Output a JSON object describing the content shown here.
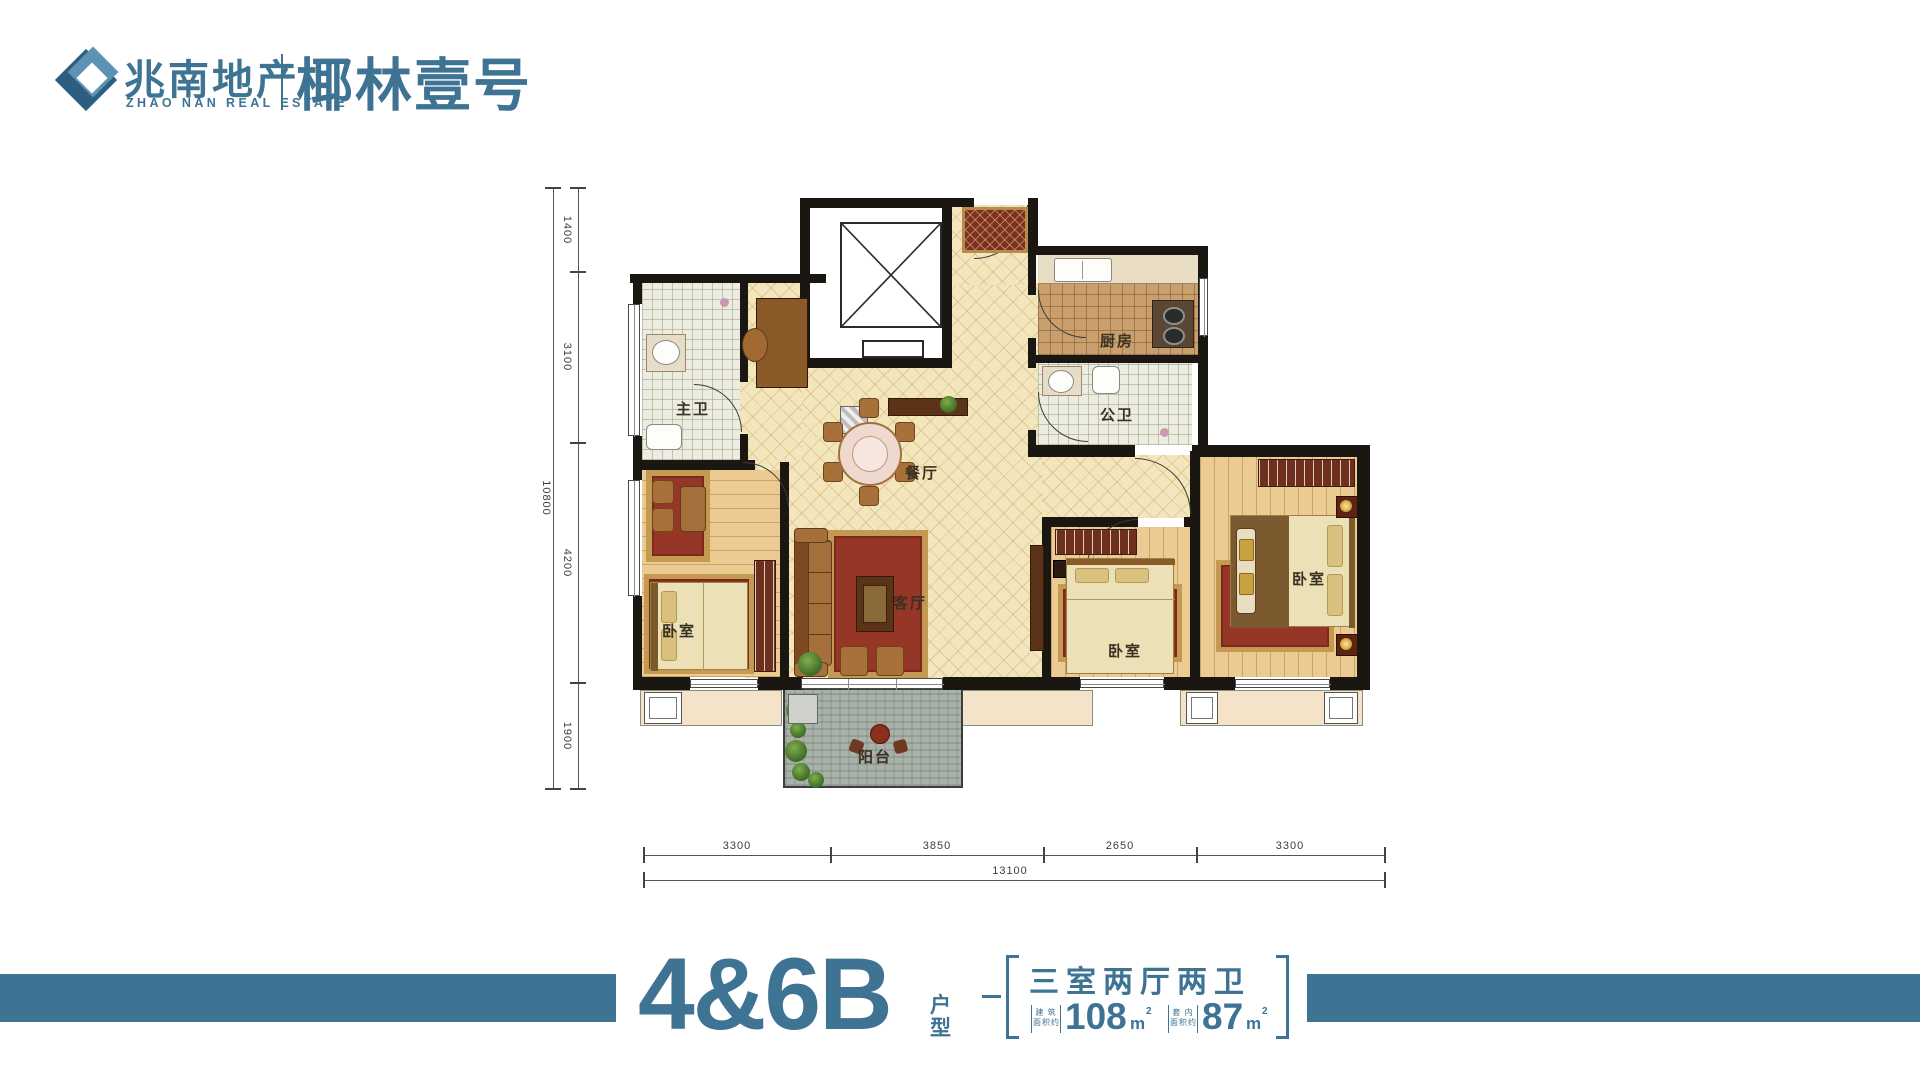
{
  "brand": {
    "name_cn": "兆南地产",
    "name_en": "ZHAO NAN REAL ESTATE",
    "project": "椰林壹号",
    "accent_color": "#3e7394"
  },
  "rooms": {
    "master_bath": "主卫",
    "kitchen": "厨房",
    "public_bath": "公卫",
    "dining": "餐厅",
    "living": "客厅",
    "bedroom_left": "卧室",
    "bedroom_mid": "卧室",
    "bedroom_right": "卧室",
    "balcony": "阳台"
  },
  "dimensions": {
    "left": {
      "total": "10800",
      "segments": [
        "1400",
        "3100",
        "4200",
        "1900"
      ]
    },
    "bottom": {
      "total": "13100",
      "segments": [
        "3300",
        "3850",
        "2650",
        "3300"
      ]
    }
  },
  "footer": {
    "unit_code": "4&6B",
    "unit_type": "户型",
    "layout": "三室两厅两卫",
    "areas": [
      {
        "label_lines": [
          "建 筑",
          "面积约"
        ],
        "value": "108",
        "unit": "m",
        "sup": "2"
      },
      {
        "label_lines": [
          "套 内",
          "面积约"
        ],
        "value": "87",
        "unit": "m",
        "sup": "2"
      }
    ]
  }
}
